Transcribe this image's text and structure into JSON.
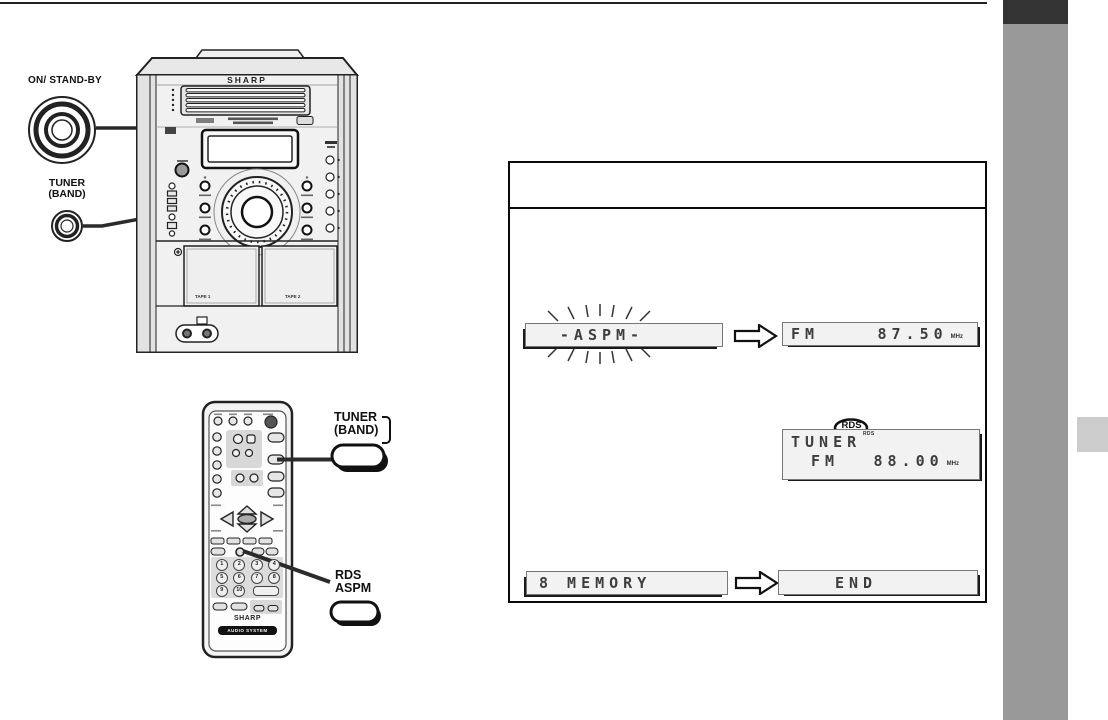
{
  "colors": {
    "sidebar_dark": "#333333",
    "sidebar_gray": "#999999",
    "sidebar_tab": "#cccccc",
    "ink": "#1a1a1a"
  },
  "unit": {
    "brand": "SHARP",
    "tape1": "TAPE 1",
    "tape2": "TAPE 2"
  },
  "callouts": {
    "power": "ON/ STAND-BY",
    "tuner_main_l1": "TUNER",
    "tuner_main_l2": "(BAND)",
    "tuner_remote_l1": "TUNER",
    "tuner_remote_l2": "(BAND)",
    "rds_l1": "RDS",
    "rds_l2": "ASPM"
  },
  "remote": {
    "brand": "SHARP",
    "system": "AUDIO SYSTEM",
    "keys": [
      "1",
      "2",
      "3",
      "4",
      "5",
      "6",
      "7",
      "8",
      "9",
      "10"
    ]
  },
  "box": {
    "step1": {
      "flashing": "-ASPM-",
      "band": "FM",
      "freq": "87.50",
      "unit": "MHz"
    },
    "step2": {
      "balloon": "RDS",
      "indicator": "RDS",
      "line1": "TUNER",
      "band": "FM",
      "freq": "88.00",
      "unit": "MHz"
    },
    "step3": {
      "left": "8 MEMORY",
      "right": "END"
    }
  }
}
